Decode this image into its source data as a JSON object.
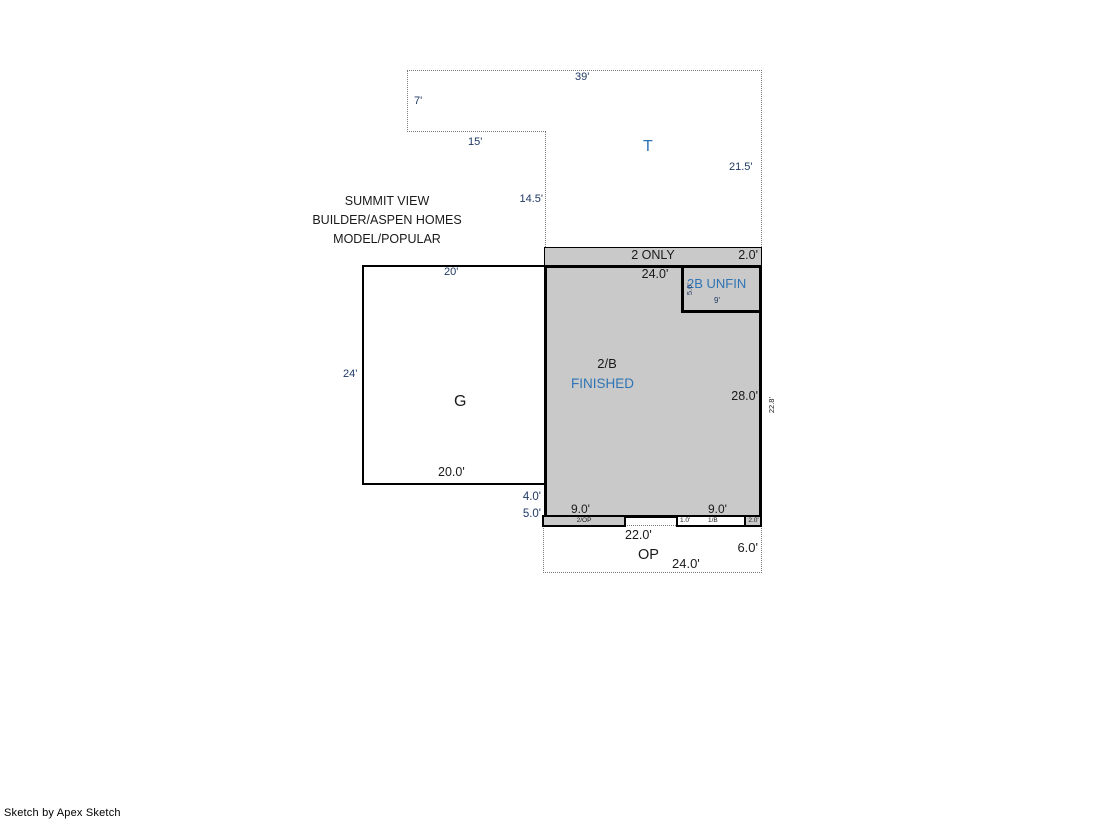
{
  "meta": {
    "watermark": "Sketch by Apex Sketch"
  },
  "colors": {
    "area_fill_gray": "#c9c9c9",
    "area_label_blue": "#2e74b5",
    "dimension_navy": "#1f3864",
    "ink": "#1a1a1a",
    "outline_black": "#000000",
    "dotted_gray": "#7a7a7a"
  },
  "annotation": {
    "lines": [
      "SUMMIT VIEW",
      "BUILDER/ASPEN HOMES",
      "MODEL/POPULAR"
    ]
  },
  "tract": {
    "label": "T",
    "dims": {
      "top": "39'",
      "upper_left": "7'",
      "step_bottom": "15'",
      "step_vertical": "14.5'",
      "right": "21.5'"
    }
  },
  "upper_story": {
    "strip_label": "2 ONLY",
    "strip_right_dim": "2.0'",
    "top_width_dim": "24.0'",
    "name_line1": "2/B",
    "name_line2": "FINISHED",
    "right_inner_dim": "28.0'",
    "right_outer_dim": "22.8'",
    "unfinished": {
      "label": "2B UNFIN",
      "left_dim": "5.0'",
      "bottom_dim": "9'"
    }
  },
  "garage": {
    "label": "G",
    "top_dim": "20'",
    "left_dim": "24'",
    "bottom_dim": "20.0'"
  },
  "lower_edge": {
    "left_dim_upper": "4.0'",
    "left_dim_lower": "5.0'",
    "bottom_dim_left": "9.0'",
    "bottom_dim_right": "9.0'",
    "strip_2op_label": "2/OP",
    "strip_1_0_dim": "1.0'",
    "strip_1b_label": "1/B",
    "strip_2_0_dim": "2.0'"
  },
  "open_porch": {
    "label": "OP",
    "dim_22": "22.0'",
    "dim_6": "6.0'",
    "dim_24": "24.0'"
  }
}
